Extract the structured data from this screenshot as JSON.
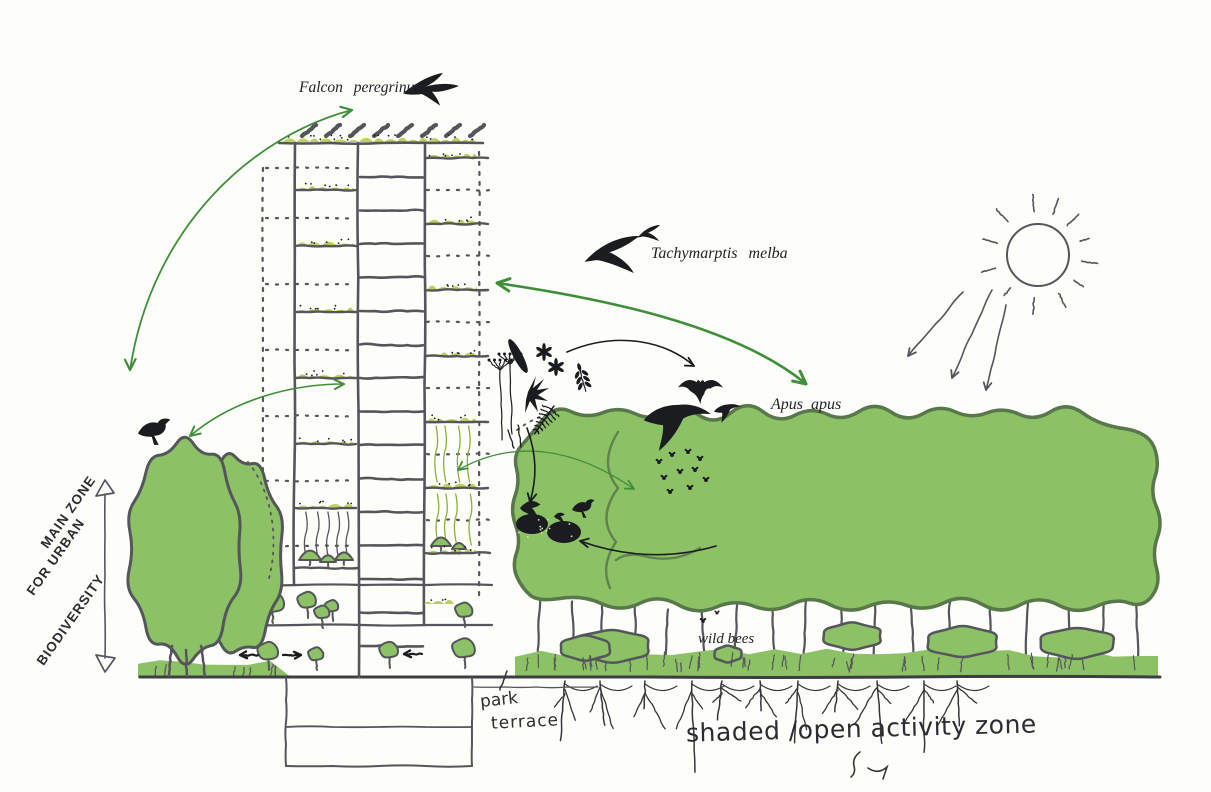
{
  "colors": {
    "paper": "#fdfdfa",
    "vegetation_green": "#8cc166",
    "balcony_vegetation": "#bcd25f",
    "canopy_outline": "#58774a",
    "sketch_ink": "#55565b",
    "silhouette_black": "#1b1c20",
    "arrow_green": "#3f8f3a",
    "handwriting_ink": "#2c2d32"
  },
  "labels": {
    "species": {
      "falcon": "Falcon peregrinus",
      "alpine_swift": "Tachymarptis melba",
      "common_swift": "Apus apus"
    },
    "wild_bees": "wild bees",
    "zone": [
      "MAIN ZONE",
      "FOR URBAN",
      "BIODIVERSITY"
    ],
    "park_terrace": [
      "park",
      "terrace"
    ],
    "activity_zone": "shaded /open activity zone"
  },
  "icons": {
    "sun-icon": "hand-drawn sun with rays",
    "sunlight-arrows-icon": "three arrows showing sunlight direction",
    "falcon-icon": "flying peregrine falcon silhouette",
    "alpine-swift-icons": "two alpine swift silhouettes",
    "common-swift-icons": "two swift silhouettes over canopy",
    "bat-icon": "flying bat silhouette",
    "perched-bird-icon": "bird perched on tree top",
    "bee-swarm-icon": "swarm of bees in canopy",
    "wild-bee-icons": "two wild bees near label",
    "bird-nest-icons": "bird nests with birds",
    "wildflower-icons": "wildflower and leaf silhouettes",
    "dimension-arrow-icon": "vertical double-headed extent arrow"
  }
}
